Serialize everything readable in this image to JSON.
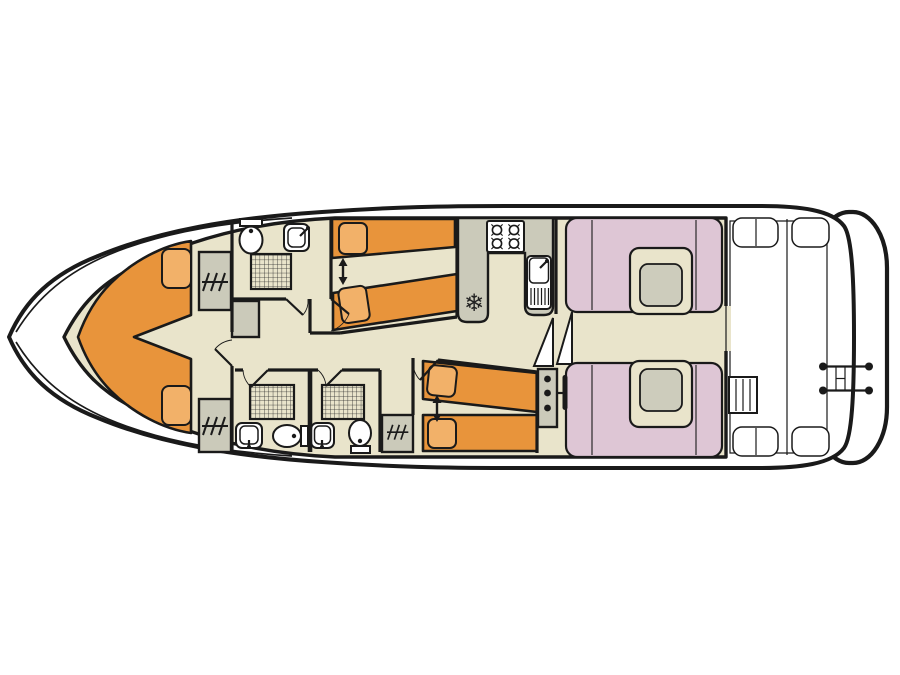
{
  "meta": {
    "description": "Top-down deck plan of a canal cruiser houseboat, bow pointing left",
    "canvas": {
      "width": 900,
      "height": 675
    }
  },
  "palette": {
    "outline": "#1a1a1a",
    "floor": "#e9e4cb",
    "furniture_gray": "#cbcaba",
    "bed_orange": "#e8943b",
    "pillow_orange": "#f2b169",
    "seat_pink": "#dec6d5",
    "table_inset": "#cdccbc",
    "hull_white": "#ffffff"
  },
  "galley": {
    "fridge_glyph": "❄"
  },
  "inventory": {
    "bow_cabin": [
      "v-berth-double-bed",
      "pillow",
      "pillow",
      "wardrobe",
      "wardrobe",
      "door"
    ],
    "forward_bathroom": [
      "toilet",
      "washbasin",
      "shower",
      "door"
    ],
    "port_mid_cabin": [
      "single-bed",
      "single-bed",
      "convertible-bed-arrow",
      "pillow",
      "pillow",
      "door"
    ],
    "starboard_mid_cabin": [
      "single-bed",
      "single-bed",
      "convertible-bed-arrow",
      "pillow",
      "pillow",
      "wardrobe",
      "door"
    ],
    "aft_bathroom_port": [
      "toilet",
      "washbasin",
      "shower",
      "door"
    ],
    "aft_bathroom_starboard": [
      "toilet",
      "washbasin",
      "shower",
      "door"
    ],
    "galley": [
      "four-burner-hob",
      "sink-with-drainer",
      "tap",
      "fridge"
    ],
    "saloon": [
      "u-shaped-dinette",
      "table",
      "u-shaped-dinette",
      "table",
      "sliding-door-to-deck"
    ],
    "helm": [
      "instrument-console",
      "steering-wheel"
    ],
    "companionway": [
      "steps"
    ],
    "aft_deck": [
      "plank-floor",
      "corner-seat",
      "corner-seat",
      "corner-seat",
      "corner-seat",
      "steps",
      "stern-rail-ladder",
      "swim-platform"
    ]
  }
}
